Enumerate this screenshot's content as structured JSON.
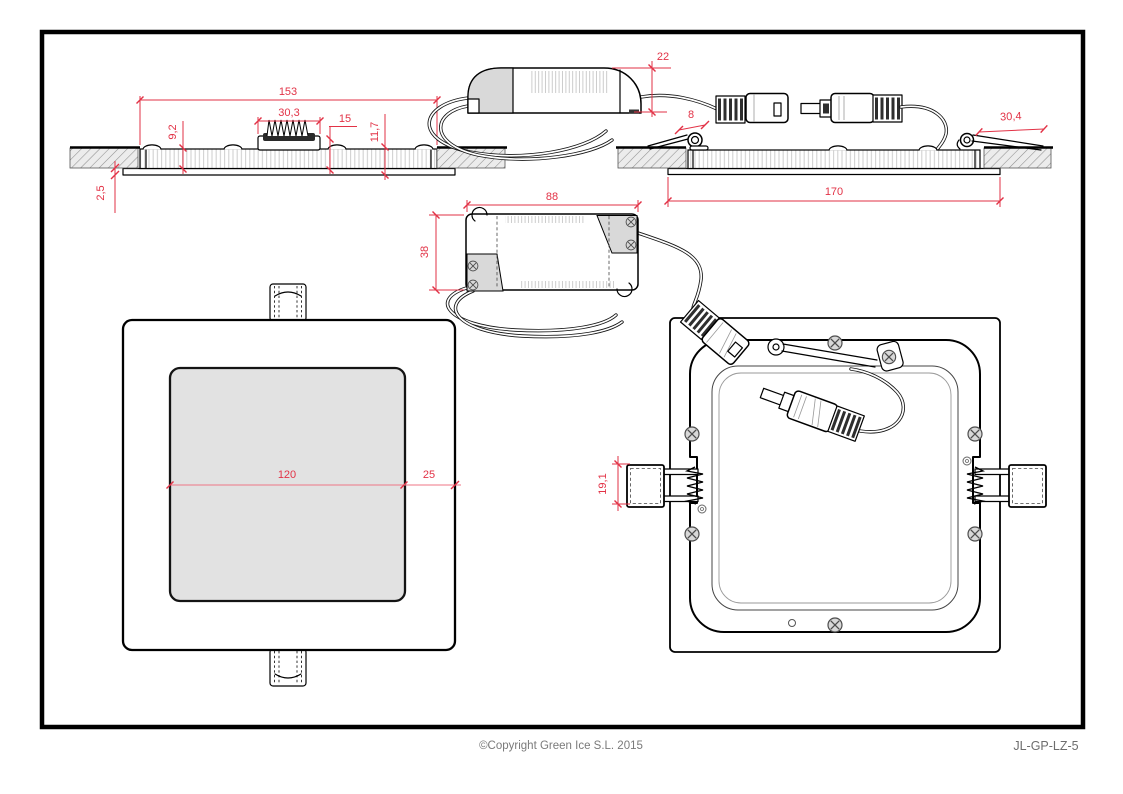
{
  "footer": {
    "copyright": "©Copyright Green Ice S.L. 2015",
    "part_number": "JL-GP-LZ-5"
  },
  "colors": {
    "dimension_red": "#e23246",
    "drawing_black": "#000000",
    "panel_gray": "#e2e2e2",
    "hatch_gray": "#ececec",
    "footer_gray": "#7a7a7a"
  },
  "views": {
    "side_section": {
      "dims": {
        "overall_width": "153",
        "heatsink_width": "30,3",
        "heatsink_height": "15",
        "recess_height": "9,2",
        "housing_height": "11,7",
        "trim_thickness": "2,5"
      }
    },
    "driver_side": {
      "dims": {
        "height": "22"
      }
    },
    "installed_section": {
      "dims": {
        "clip_loop_width": "8",
        "spring_arm_length": "30,4",
        "trim_width": "170"
      }
    },
    "driver_top": {
      "dims": {
        "length": "88",
        "width": "38"
      }
    },
    "front_view": {
      "dims": {
        "light_aperture": "120",
        "bezel_width": "25"
      }
    },
    "rear_view": {
      "dims": {
        "clip_height": "19,1"
      }
    }
  }
}
